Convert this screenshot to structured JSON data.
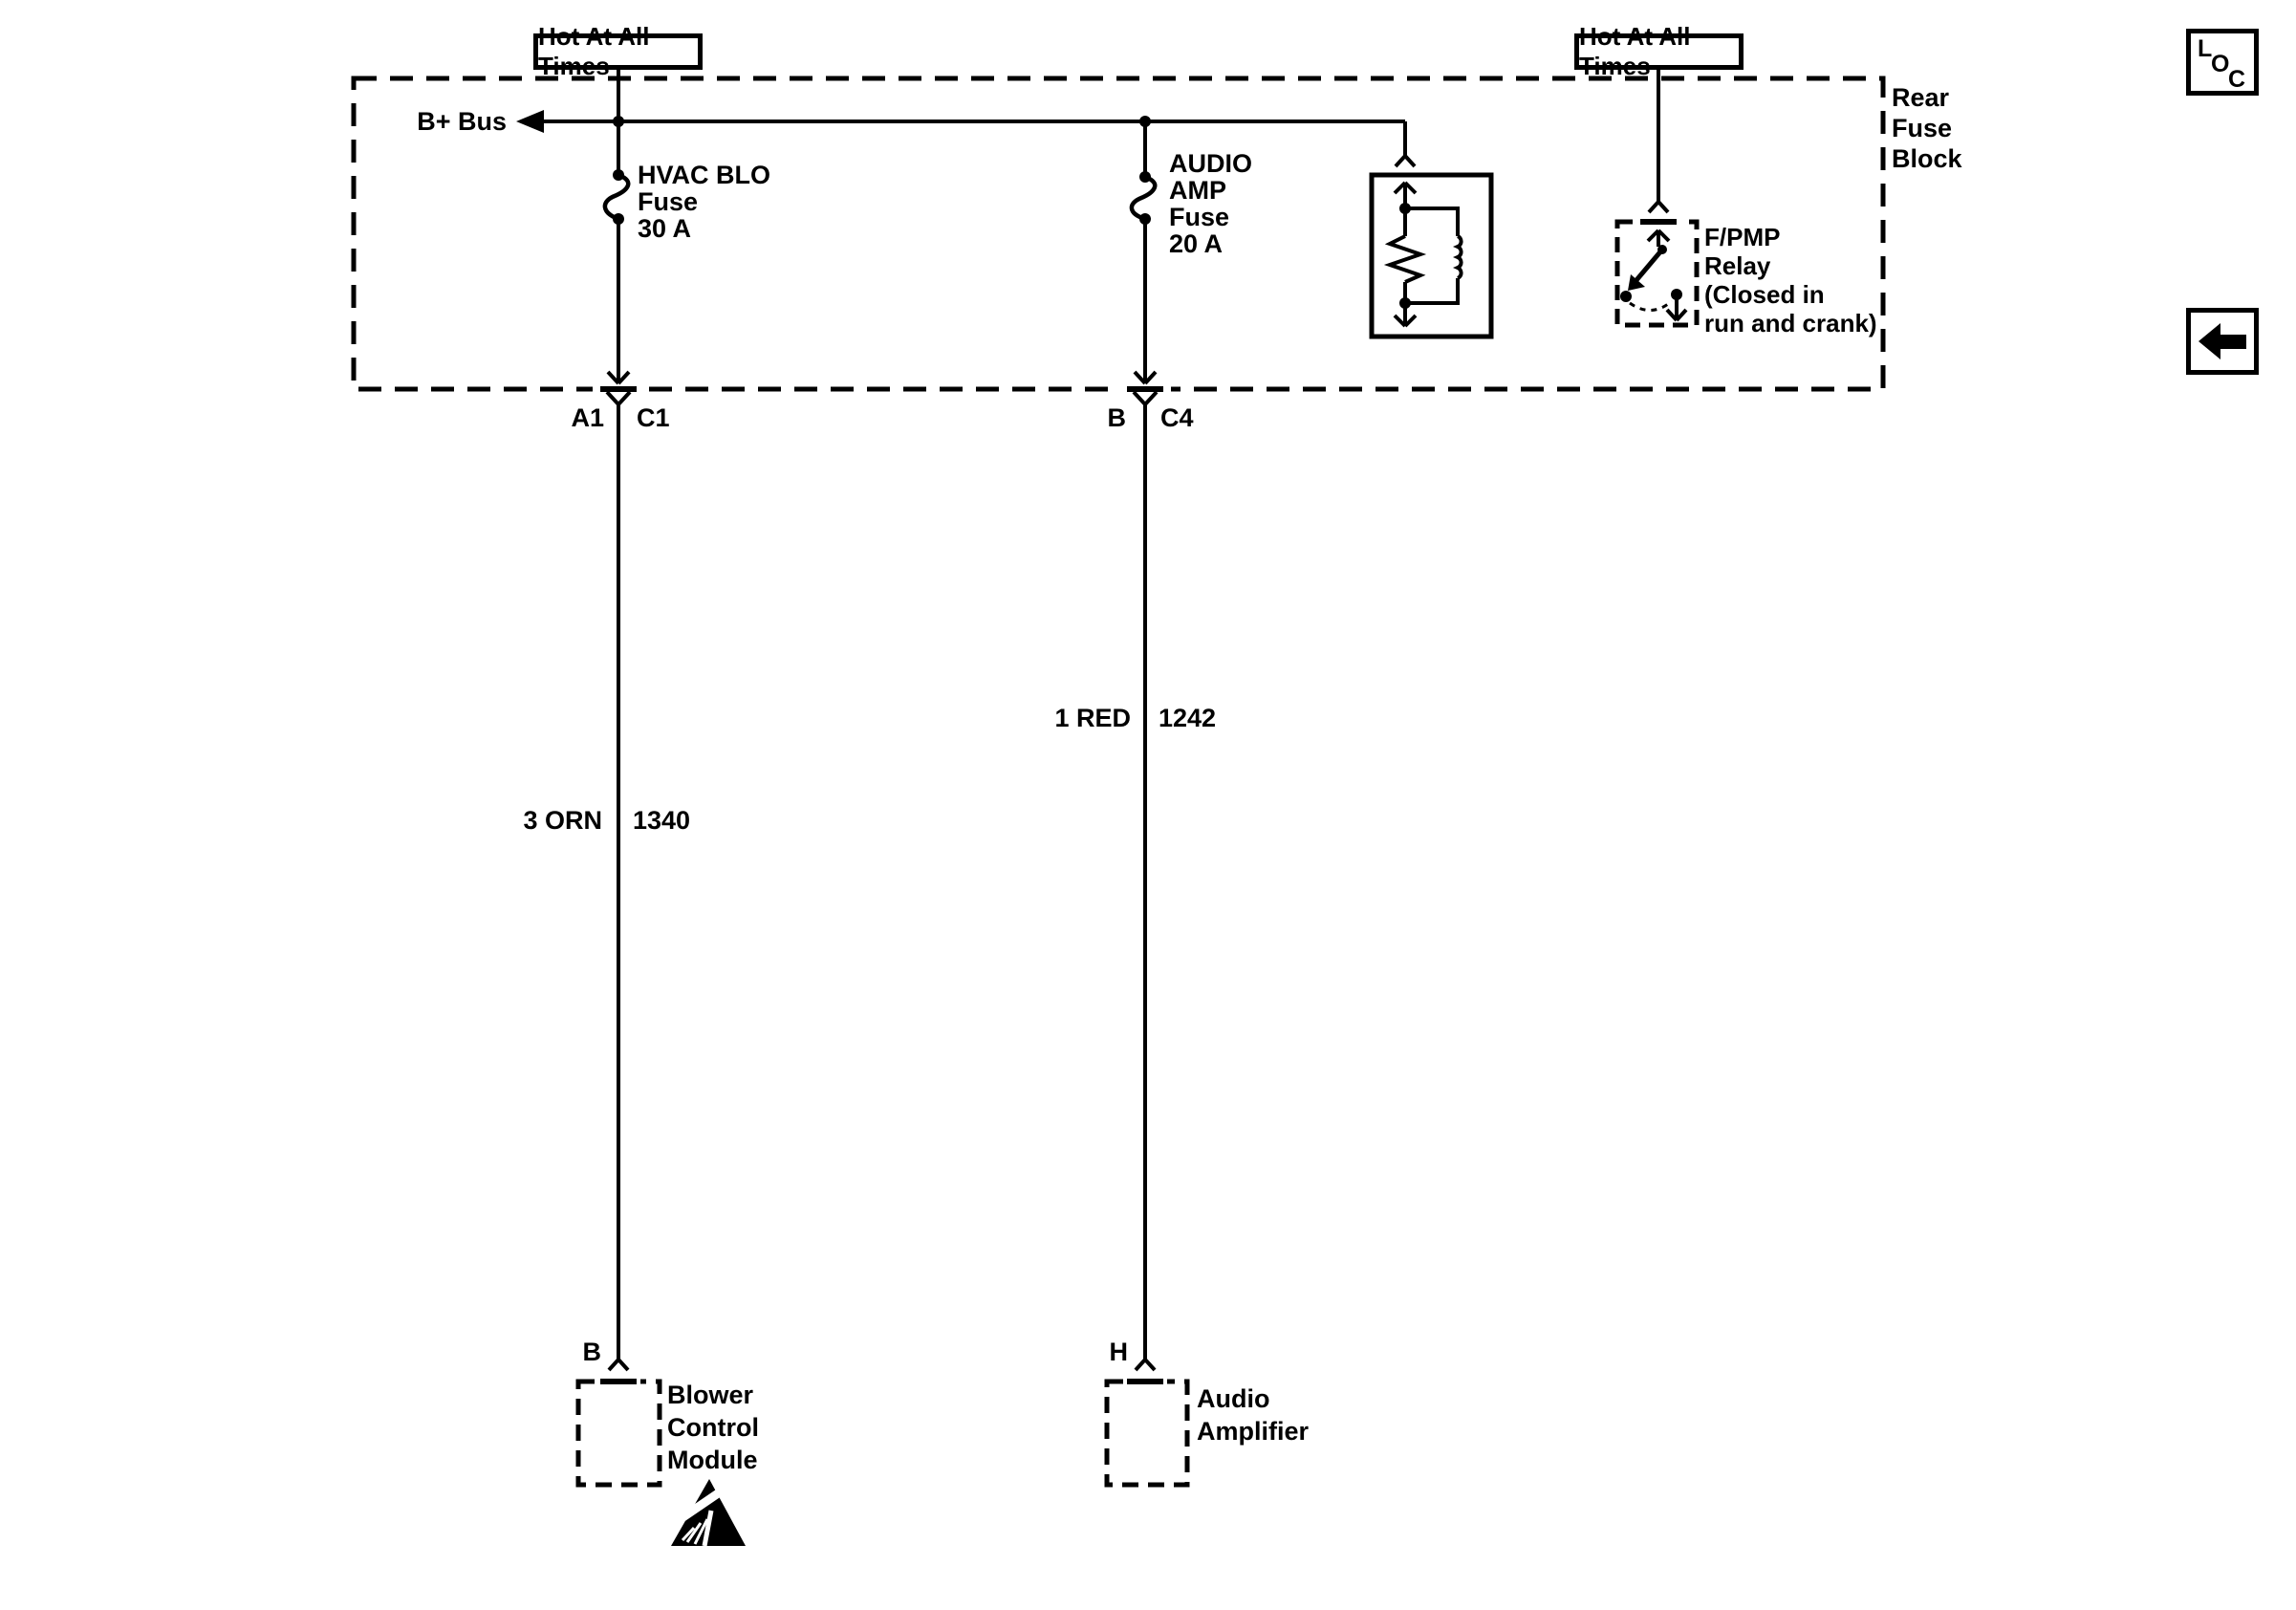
{
  "diagram": {
    "power": {
      "left_label": "Hot At All Times",
      "right_label": "Hot At All Times"
    },
    "fuse_block": {
      "title_lines": [
        "Rear",
        "Fuse",
        "Block"
      ],
      "bus_label": "B+ Bus",
      "hvac_fuse_lines": [
        "HVAC BLO",
        "Fuse",
        "30 A"
      ],
      "audio_fuse_lines": [
        "AUDIO",
        "AMP",
        "Fuse",
        "20 A"
      ],
      "relay_label_lines": [
        "F/PMP",
        "Relay",
        "(Closed in",
        "run and crank)"
      ]
    },
    "inline_connectors": {
      "left": {
        "pin": "A1",
        "connector": "C1"
      },
      "right": {
        "pin": "B",
        "connector": "C4"
      }
    },
    "wires": {
      "left": {
        "label": "3 ORN",
        "circuit": "1340"
      },
      "right": {
        "label": "1 RED",
        "circuit": "1242"
      }
    },
    "modules": {
      "left": {
        "pin": "B",
        "name_lines": [
          "Blower",
          "Control",
          "Module"
        ]
      },
      "right": {
        "pin": "H",
        "name_lines": [
          "Audio",
          "Amplifier"
        ]
      }
    },
    "nav": {
      "loc_letters": [
        "L",
        "O",
        "C"
      ]
    },
    "colors": {
      "ink": "#000000",
      "paper": "#ffffff"
    }
  }
}
